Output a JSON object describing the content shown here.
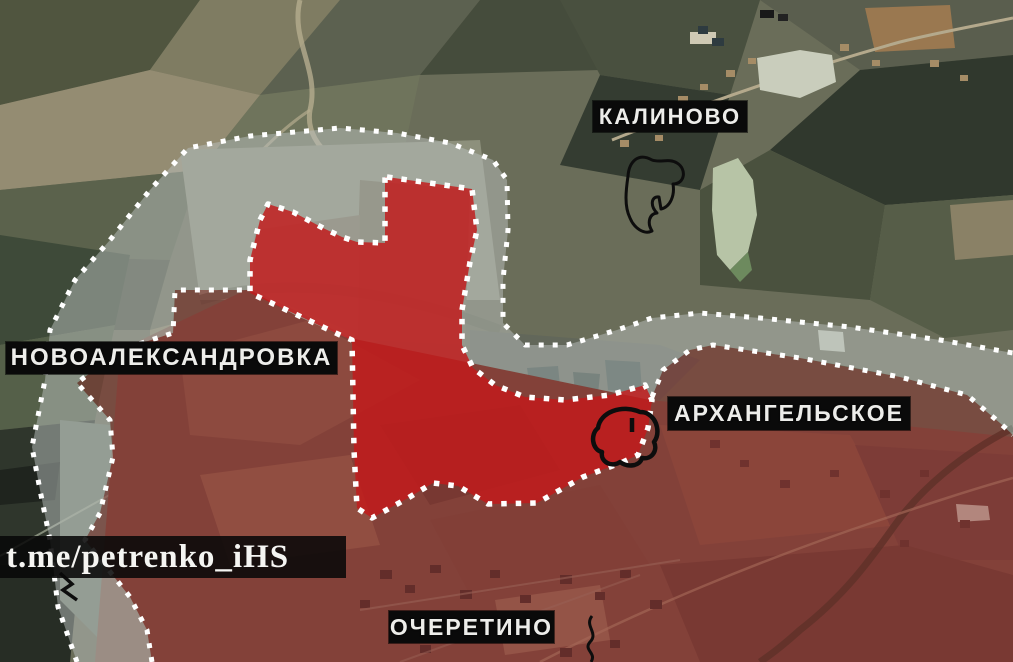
{
  "labels": {
    "kalinovo": "КАЛИНОВО",
    "novoaleksandrovka": "НОВОАЛЕКСАНДРОВКА",
    "arkhangelskoye": "АРХАНГЕЛЬСКОЕ",
    "ocheretino": "ОЧЕРЕТИНО"
  },
  "watermark": "t.me/petrenko_iHS",
  "colors": {
    "advance_zone_fill": "#c31a1b",
    "contested_zone_fill": "#b9bfbe",
    "controlled_zone_fill": "#8c1f22",
    "border_dots": "#ffffff",
    "label_background": "#0a0a0a",
    "label_text": "#ededea"
  }
}
